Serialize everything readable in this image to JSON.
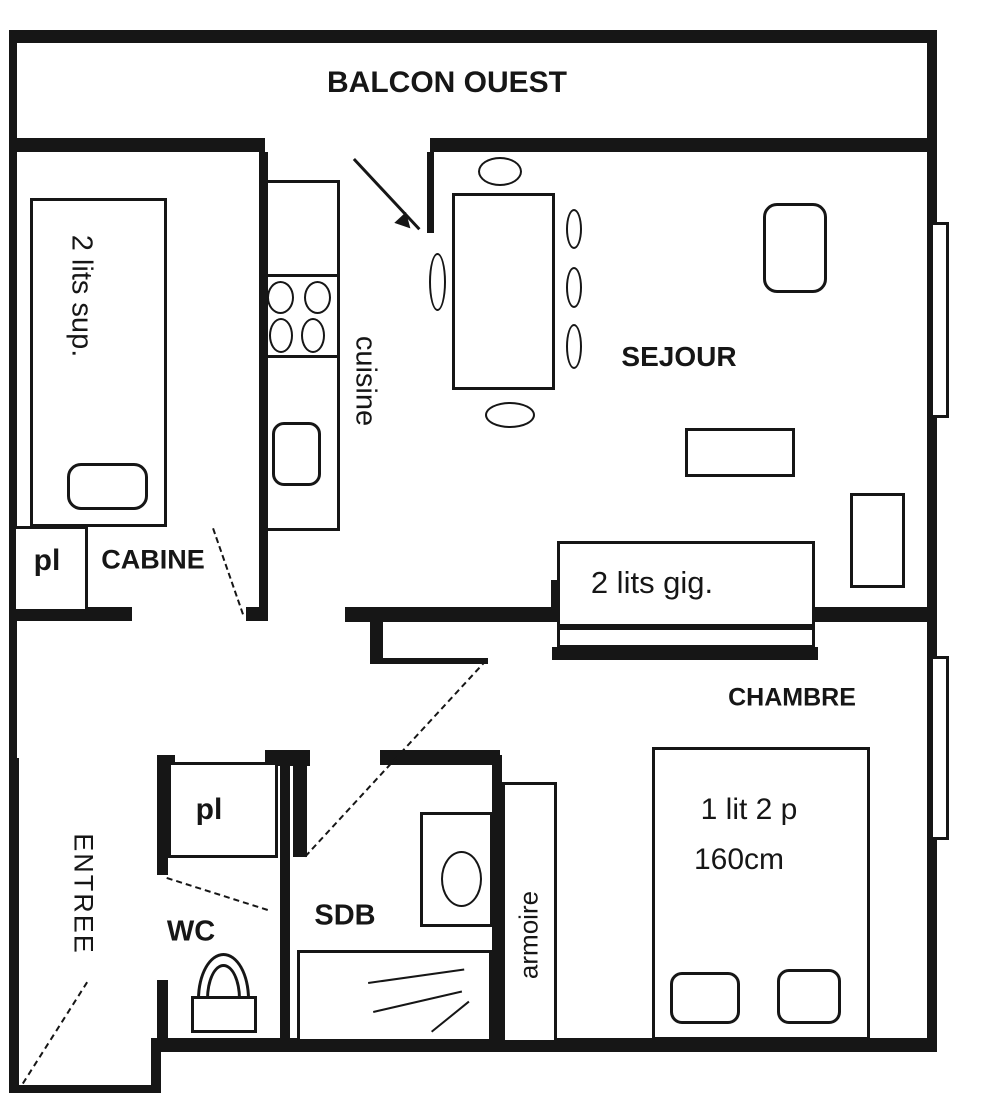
{
  "colors": {
    "line": "#161616",
    "background": "#ffffff"
  },
  "labels": {
    "balcony": "BALCON OUEST",
    "living_room": "SEJOUR",
    "cabin_room": "CABINE",
    "bedroom": "CHAMBRE",
    "kitchen": "cuisine",
    "entry_hall": "ENTREE",
    "toilet_room": "WC",
    "bathroom": "SDB",
    "wardrobe": "armoire",
    "closet_cabin": "pl",
    "closet_hall": "pl",
    "bunk_beds": "2 lits sup.",
    "nesting_beds": "2 lits gig.",
    "double_bed_line1": "1 lit 2 p",
    "double_bed_line2": "160cm"
  }
}
